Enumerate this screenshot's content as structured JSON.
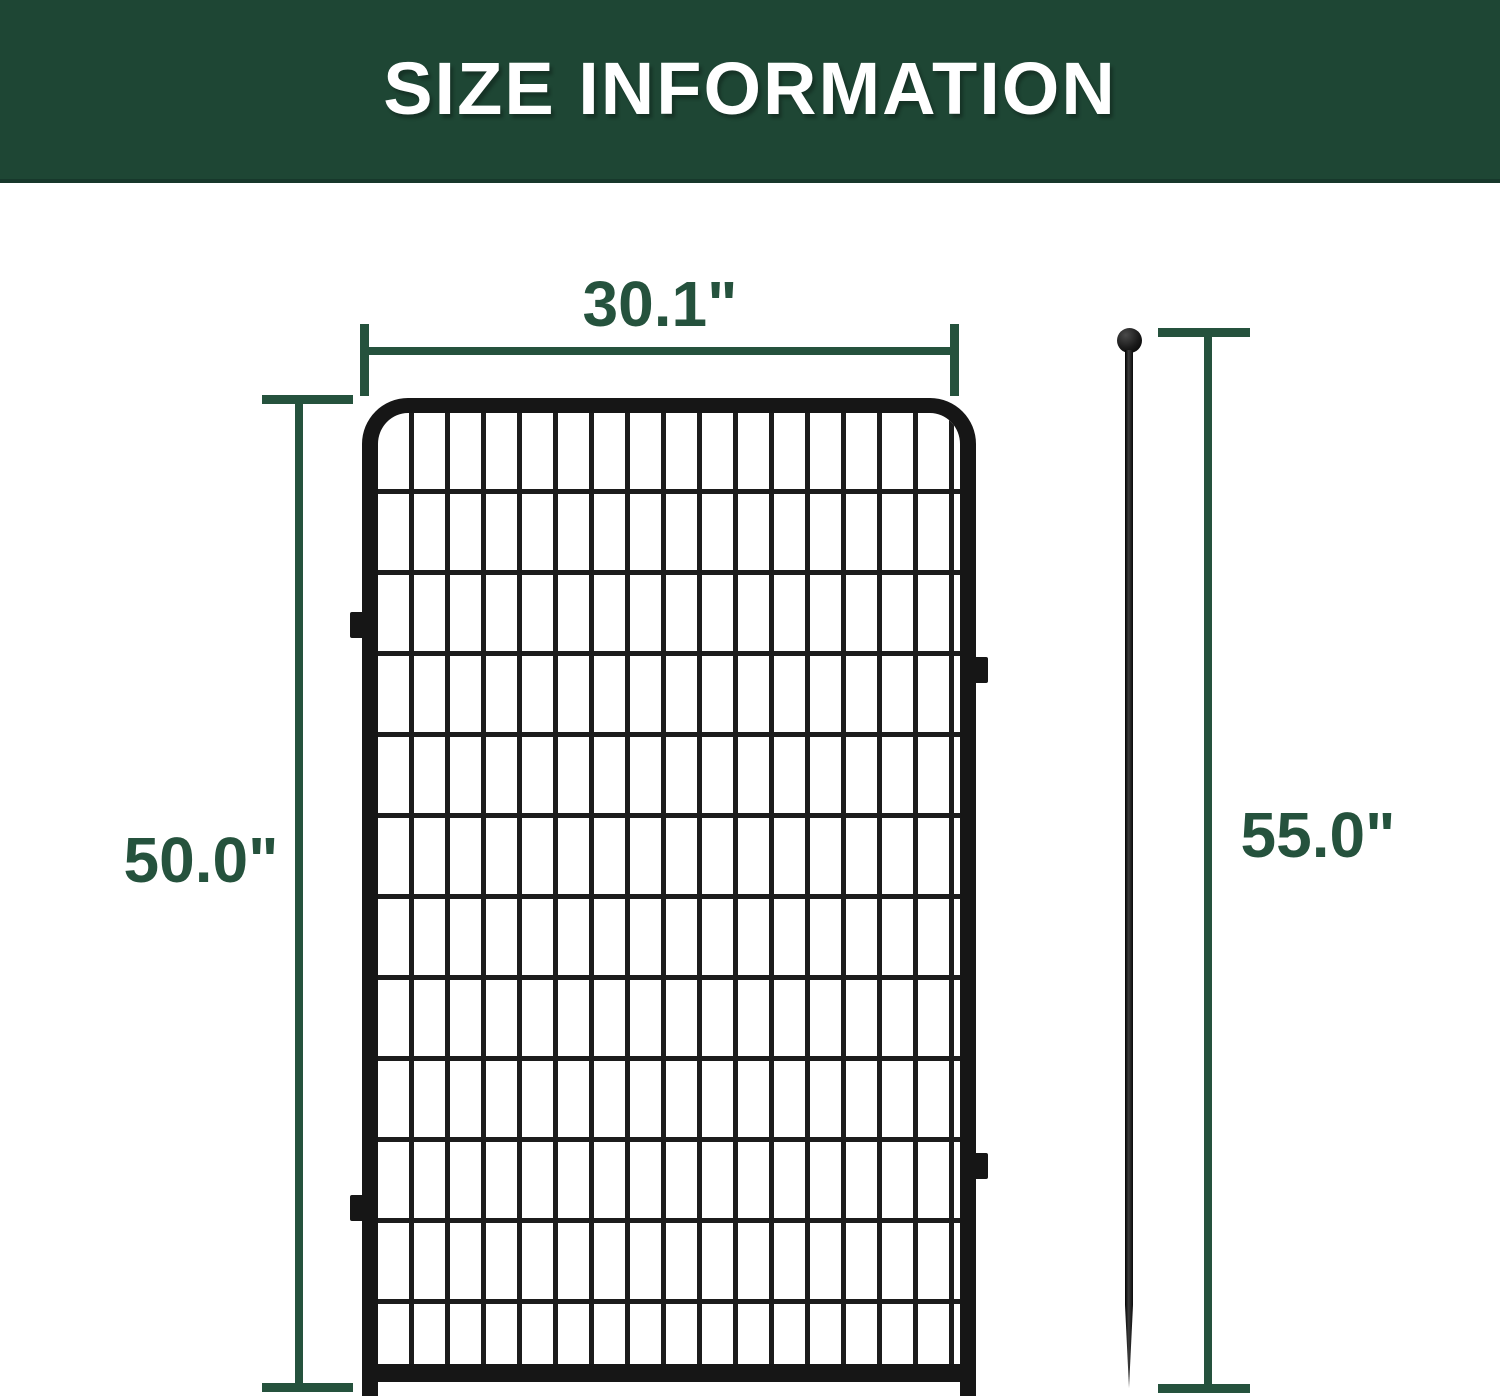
{
  "header": {
    "title": "SIZE INFORMATION"
  },
  "dimensions": {
    "panel_width": "30.1\"",
    "panel_height": "50.0\"",
    "stake_height": "55.0\""
  },
  "colors": {
    "header_bg": "#1e4634",
    "header_text": "#ffffff",
    "dimension_green": "#25523d",
    "frame_black": "#161616",
    "wire_black": "#1c1c1c",
    "page_bg": "#ffffff"
  }
}
